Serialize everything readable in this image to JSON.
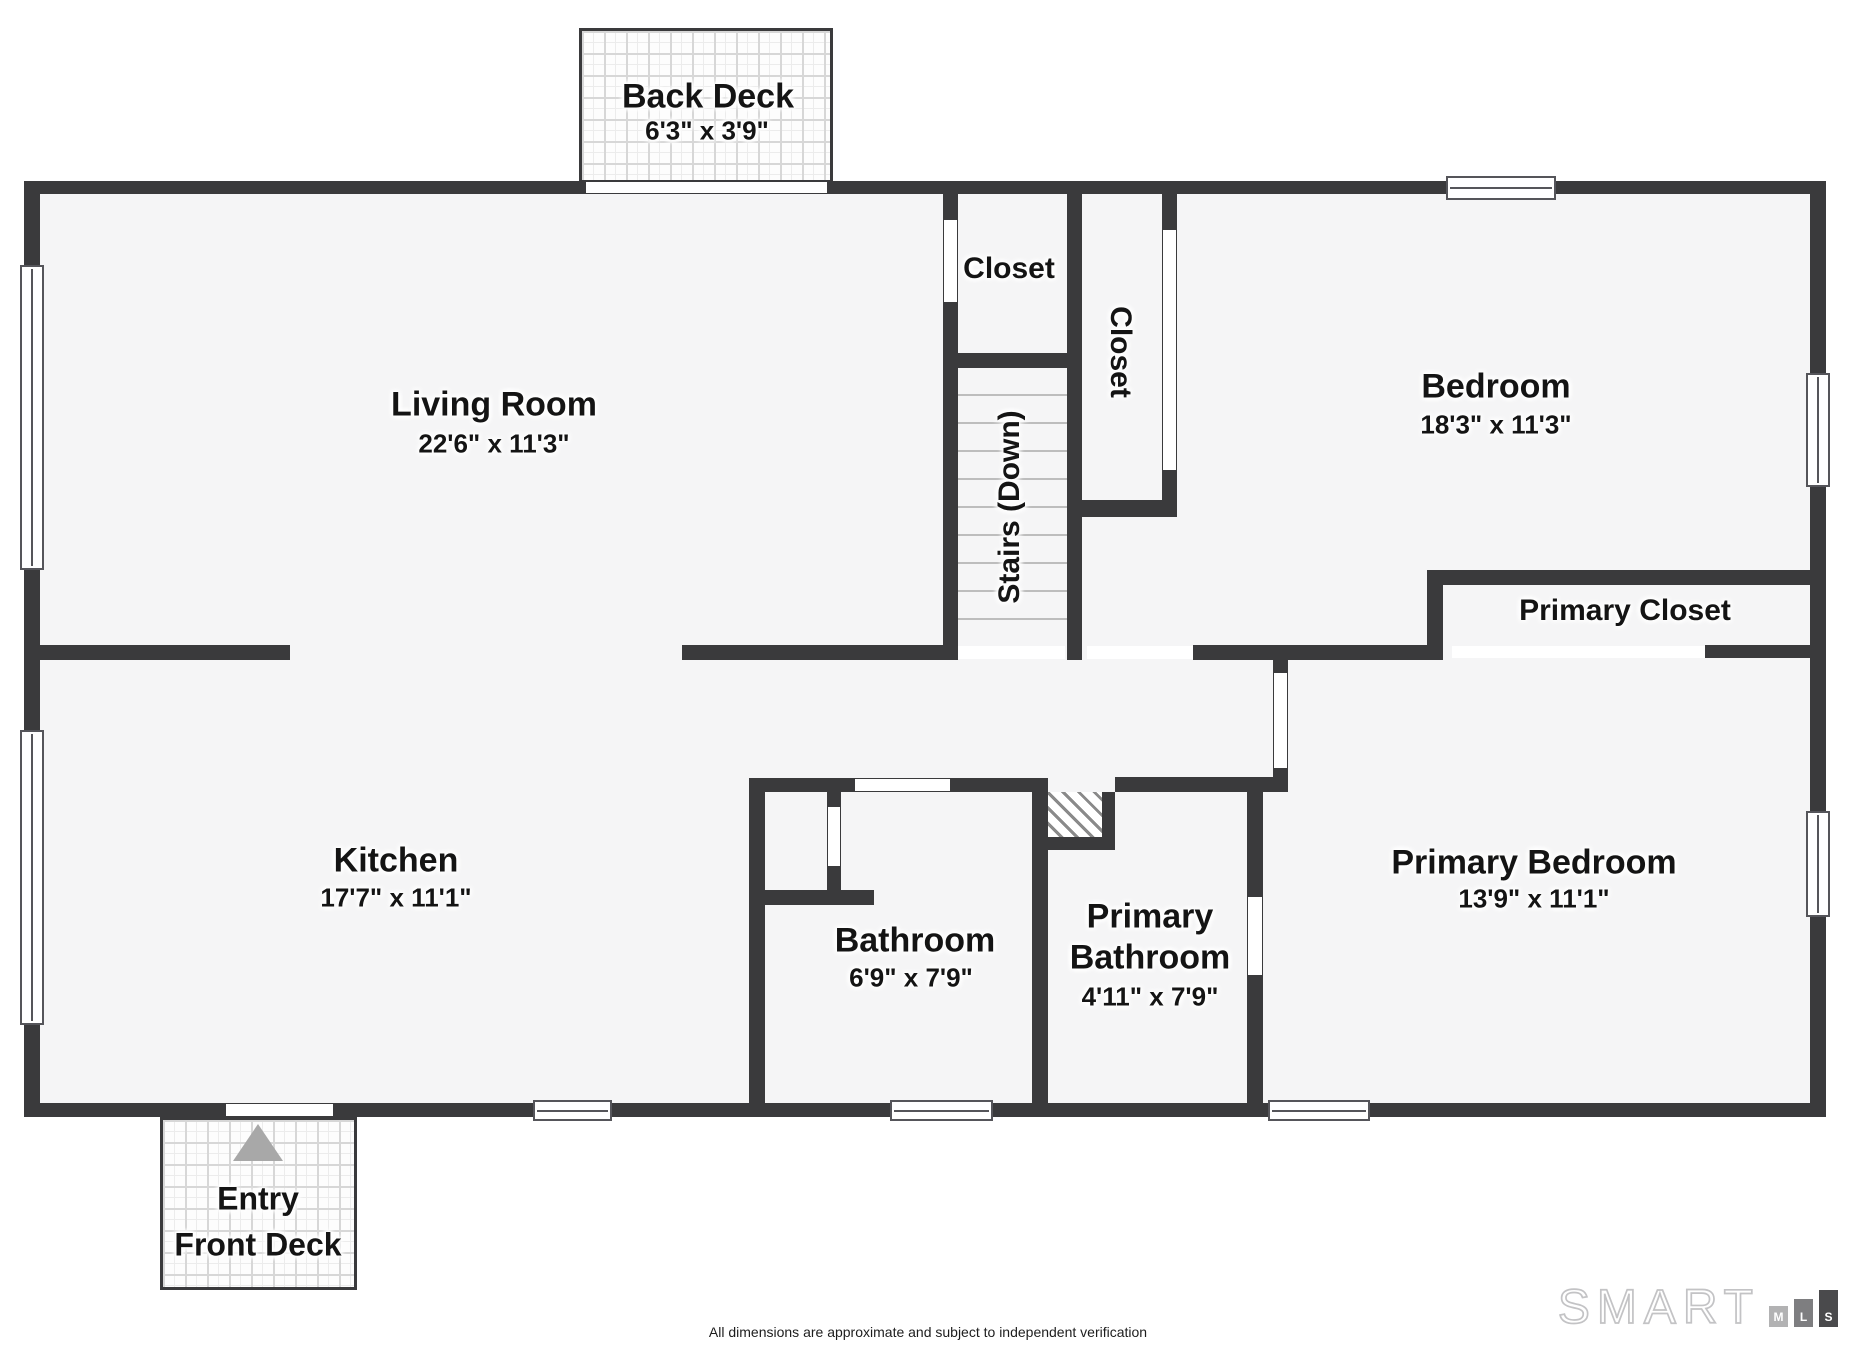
{
  "rooms": {
    "back_deck": {
      "name": "Back Deck",
      "dims": "6'3\" x 3'9\""
    },
    "living_room": {
      "name": "Living Room",
      "dims": "22'6\" x 11'3\""
    },
    "closet_top": {
      "name": "Closet"
    },
    "closet_bedroom": {
      "name": "Closet"
    },
    "stairs": {
      "name": "Stairs (Down)"
    },
    "bedroom": {
      "name": "Bedroom",
      "dims": "18'3\" x 11'3\""
    },
    "primary_closet": {
      "name": "Primary Closet"
    },
    "kitchen": {
      "name": "Kitchen",
      "dims": "17'7\" x 11'1\""
    },
    "bathroom": {
      "name": "Bathroom",
      "dims": "6'9\" x 7'9\""
    },
    "primary_bathroom": {
      "name_line1": "Primary",
      "name_line2": "Bathroom",
      "dims": "4'11\" x 7'9\""
    },
    "primary_bedroom": {
      "name": "Primary Bedroom",
      "dims": "13'9\" x 11'1\""
    },
    "front_deck": {
      "name_line1": "Entry",
      "name_line2": "Front Deck"
    }
  },
  "footer": {
    "disclaimer": "All dimensions are approximate and subject to independent verification"
  },
  "logo": {
    "word": "SMART",
    "bars": [
      "M",
      "L",
      "S"
    ]
  },
  "colors": {
    "wall": "#3a3a3c",
    "floor": "#f5f5f6",
    "entry_arrow": "#a8a8a8",
    "logo_bar_m": "#b2b2b3",
    "logo_bar_l": "#7e7e80",
    "logo_bar_s": "#4a4a4c"
  }
}
